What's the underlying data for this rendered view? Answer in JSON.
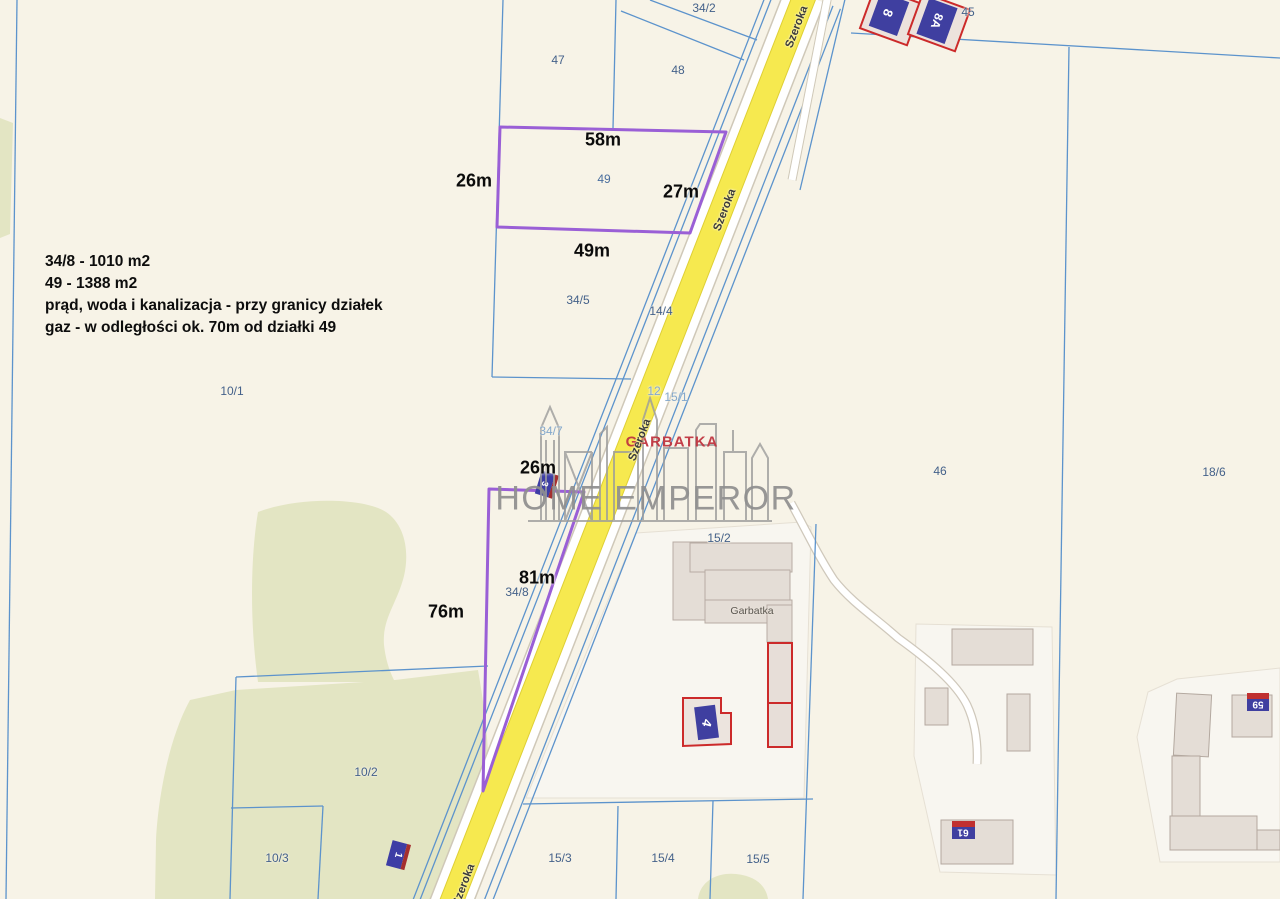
{
  "map_type": "cadastral-map",
  "info_box": {
    "line1": "34/8 - 1010 m2",
    "line2": "49 - 1388 m2",
    "line3": "prąd, woda i kanalizacja - przy granicy działek",
    "line4": "gaz - w odległości ok. 70m od działki 49"
  },
  "watermark": {
    "brand": "HOME EMPEROR",
    "location": "GARBATKA"
  },
  "road": {
    "name": "Szeroka"
  },
  "parcels": {
    "p34_2": "34/2",
    "p47": "47",
    "p48": "48",
    "p45": "45",
    "p49": "49",
    "p34_5": "34/5",
    "p14_4": "14/4",
    "p10_1": "10/1",
    "p34_7": "34/7",
    "p12": "12",
    "p15_1": "15/1",
    "p46": "46",
    "p18_6": "18/6",
    "p15_2": "15/2",
    "p34_8": "34/8",
    "p10_2": "10/2",
    "p10_3": "10/3",
    "p15_3": "15/3",
    "p15_4": "15/4",
    "p15_5": "15/5"
  },
  "measurements": {
    "plot49_top": "58m",
    "plot49_left": "26m",
    "plot49_right": "27m",
    "plot49_bottom": "49m",
    "plot34_8_top": "26m",
    "plot34_8_side": "81m",
    "plot34_8_left": "76m"
  },
  "buildings": {
    "b8": "8",
    "b8a": "8A",
    "b4": "4",
    "b3": "3",
    "b1": "1",
    "b59": "59",
    "b61": "61",
    "garbatka_label": "Garbatka"
  },
  "colors": {
    "background": "#f7f3e7",
    "parcel_line_blue": "#5c93cc",
    "highlight_purple": "#9a5fd6",
    "road_yellow": "#f6e94f",
    "building_gray": "#e4ddd6",
    "building_red_outline": "#cc2a2a",
    "address_blue": "#3f3fa0",
    "green_area": "#e3e5c3",
    "watermark_gray": "#8f8f8f",
    "watermark_red": "#c03540"
  }
}
